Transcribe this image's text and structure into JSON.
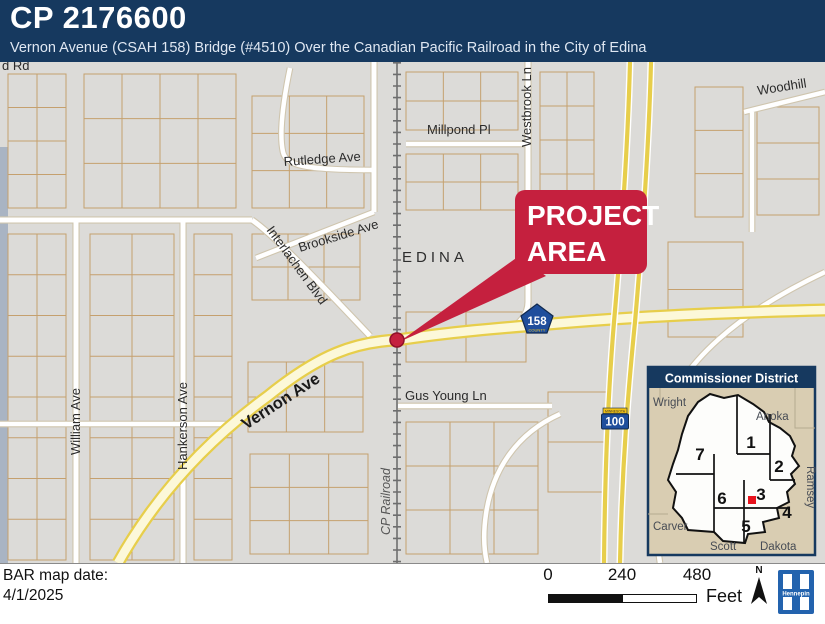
{
  "header": {
    "project_id": "CP 2176600",
    "subtitle": "Vernon Avenue (CSAH 158) Bridge (#4510) Over the Canadian Pacific Railroad in the City of Edina"
  },
  "map": {
    "city_label": "EDINA",
    "callout": {
      "line1": "PROJECT",
      "line2": "AREA"
    },
    "streets": {
      "partial_road": "d Rd",
      "millpond": "Millpond Pl",
      "westbrook": "Westbrook Ln",
      "woodhill": "Woodhill",
      "rutledge": "Rutledge Ave",
      "brookside": "Brookside Ave",
      "interlachen": "Interlachen Blvd",
      "vernon": "Vernon Ave",
      "gus_young": "Gus Young Ln",
      "william": "William Ave",
      "hankerson": "Hankerson Ave",
      "cp_railroad": "CP Railroad"
    },
    "shields": {
      "route_158": "158",
      "route_158_banner": "COUNTY",
      "route_100": "100",
      "route_100_banner": "MINNESOTA"
    }
  },
  "inset": {
    "title": "Commissioner District",
    "districts": [
      "1",
      "2",
      "3",
      "4",
      "5",
      "6",
      "7"
    ],
    "counties": {
      "wright": "Wright",
      "anoka": "Anoka",
      "ramsey": "Ramsey",
      "dakota": "Dakota",
      "scott": "Scott",
      "carver": "Carver"
    }
  },
  "footer": {
    "date_label": "BAR map date:",
    "date_value": "4/1/2025",
    "scale_ticks": [
      "0",
      "240",
      "480"
    ],
    "scale_unit": "Feet",
    "north": "N",
    "logo": "Hennepin"
  },
  "colors": {
    "navy": "#16395F",
    "red": "#C5203E",
    "road_yellow": "#E7CE4B",
    "road_fill": "#FCF8D9",
    "map_bg": "#DCDBD8",
    "parcel": "#C5A06E",
    "inset_tan": "#D9CDB2",
    "logo_blue": "#2363AE",
    "shield_blue": "#1F4E9C",
    "water": "#A9B4C3"
  }
}
